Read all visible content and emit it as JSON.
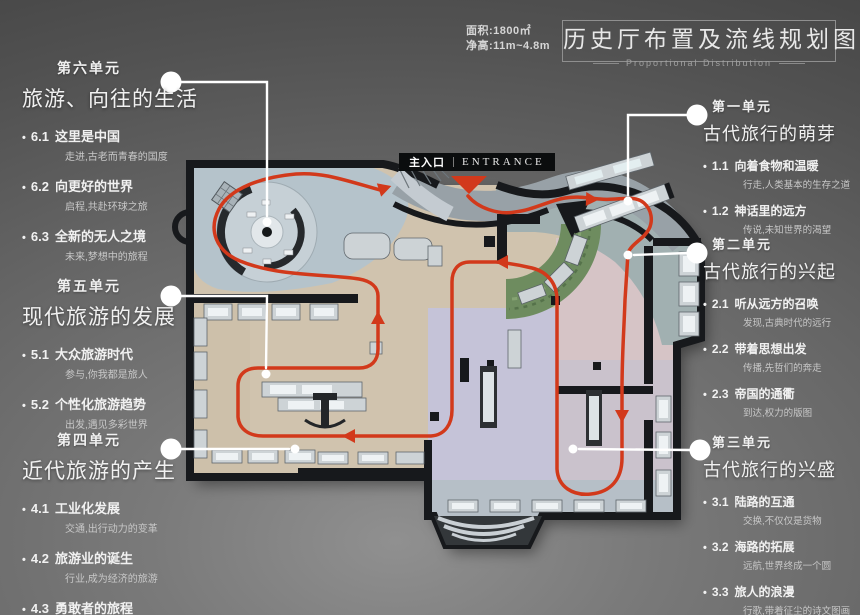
{
  "header": {
    "area_label": "面积:1800㎡",
    "height_label": "净高:11m~4.8m",
    "title": "历史厅布置及流线规划图",
    "subtitle": "Proportional Distribution"
  },
  "entrance": {
    "cn": "主入口",
    "en": "ENTRANCE"
  },
  "units": [
    {
      "header": "第一单元",
      "title": "古代旅行的萌芽",
      "items": [
        {
          "num": "1.1",
          "title": "向着食物和温暖",
          "desc": "行走,人类基本的生存之道"
        },
        {
          "num": "1.2",
          "title": "神话里的远方",
          "desc": "传说,未知世界的渴望"
        }
      ]
    },
    {
      "header": "第二单元",
      "title": "古代旅行的兴起",
      "items": [
        {
          "num": "2.1",
          "title": "听从远方的召唤",
          "desc": "发现,古典时代的远行"
        },
        {
          "num": "2.2",
          "title": "带着思想出发",
          "desc": "传播,先哲们的奔走"
        },
        {
          "num": "2.3",
          "title": "帝国的通衢",
          "desc": "到达,权力的版图"
        }
      ]
    },
    {
      "header": "第三单元",
      "title": "古代旅行的兴盛",
      "items": [
        {
          "num": "3.1",
          "title": "陆路的互通",
          "desc": "交换,不仅仅是货物"
        },
        {
          "num": "3.2",
          "title": "海路的拓展",
          "desc": "远航,世界终成一个圆"
        },
        {
          "num": "3.3",
          "title": "旅人的浪漫",
          "desc": "行歌,带着征尘的诗文图画"
        }
      ]
    },
    {
      "header": "第四单元",
      "title": "近代旅游的产生",
      "items": [
        {
          "num": "4.1",
          "title": "工业化发展",
          "desc": "交通,出行动力的变革"
        },
        {
          "num": "4.2",
          "title": "旅游业的诞生",
          "desc": "行业,成为经济的旅游"
        },
        {
          "num": "4.3",
          "title": "勇敢者的旅程",
          "desc": "开辟,重新发现世界"
        }
      ]
    },
    {
      "header": "第五单元",
      "title": "现代旅游的发展",
      "items": [
        {
          "num": "5.1",
          "title": "大众旅游时代",
          "desc": "参与,你我都是旅人"
        },
        {
          "num": "5.2",
          "title": "个性化旅游趋势",
          "desc": "出发,遇见多彩世界"
        }
      ]
    },
    {
      "header": "第六单元",
      "title": "旅游、向往的生活",
      "items": [
        {
          "num": "6.1",
          "title": "这里是中国",
          "desc": "走进,古老而青春的国度"
        },
        {
          "num": "6.2",
          "title": "向更好的世界",
          "desc": "启程,共赴环球之旅"
        },
        {
          "num": "6.3",
          "title": "全新的无人之境",
          "desc": "未来,梦想中的旅程"
        }
      ]
    }
  ],
  "colors": {
    "accent_red": "#d2391b",
    "wall_dark": "#17191c",
    "floor_beige": "#d0c3ae",
    "room_blue_gray": "#b5c3cb",
    "room_teal": "#a1b0b1",
    "room_pink": "#d6c4c6",
    "room_lavender": "#c5c3d8",
    "garden_green": "#6e8c5f",
    "callout_white": "#ffffff"
  }
}
